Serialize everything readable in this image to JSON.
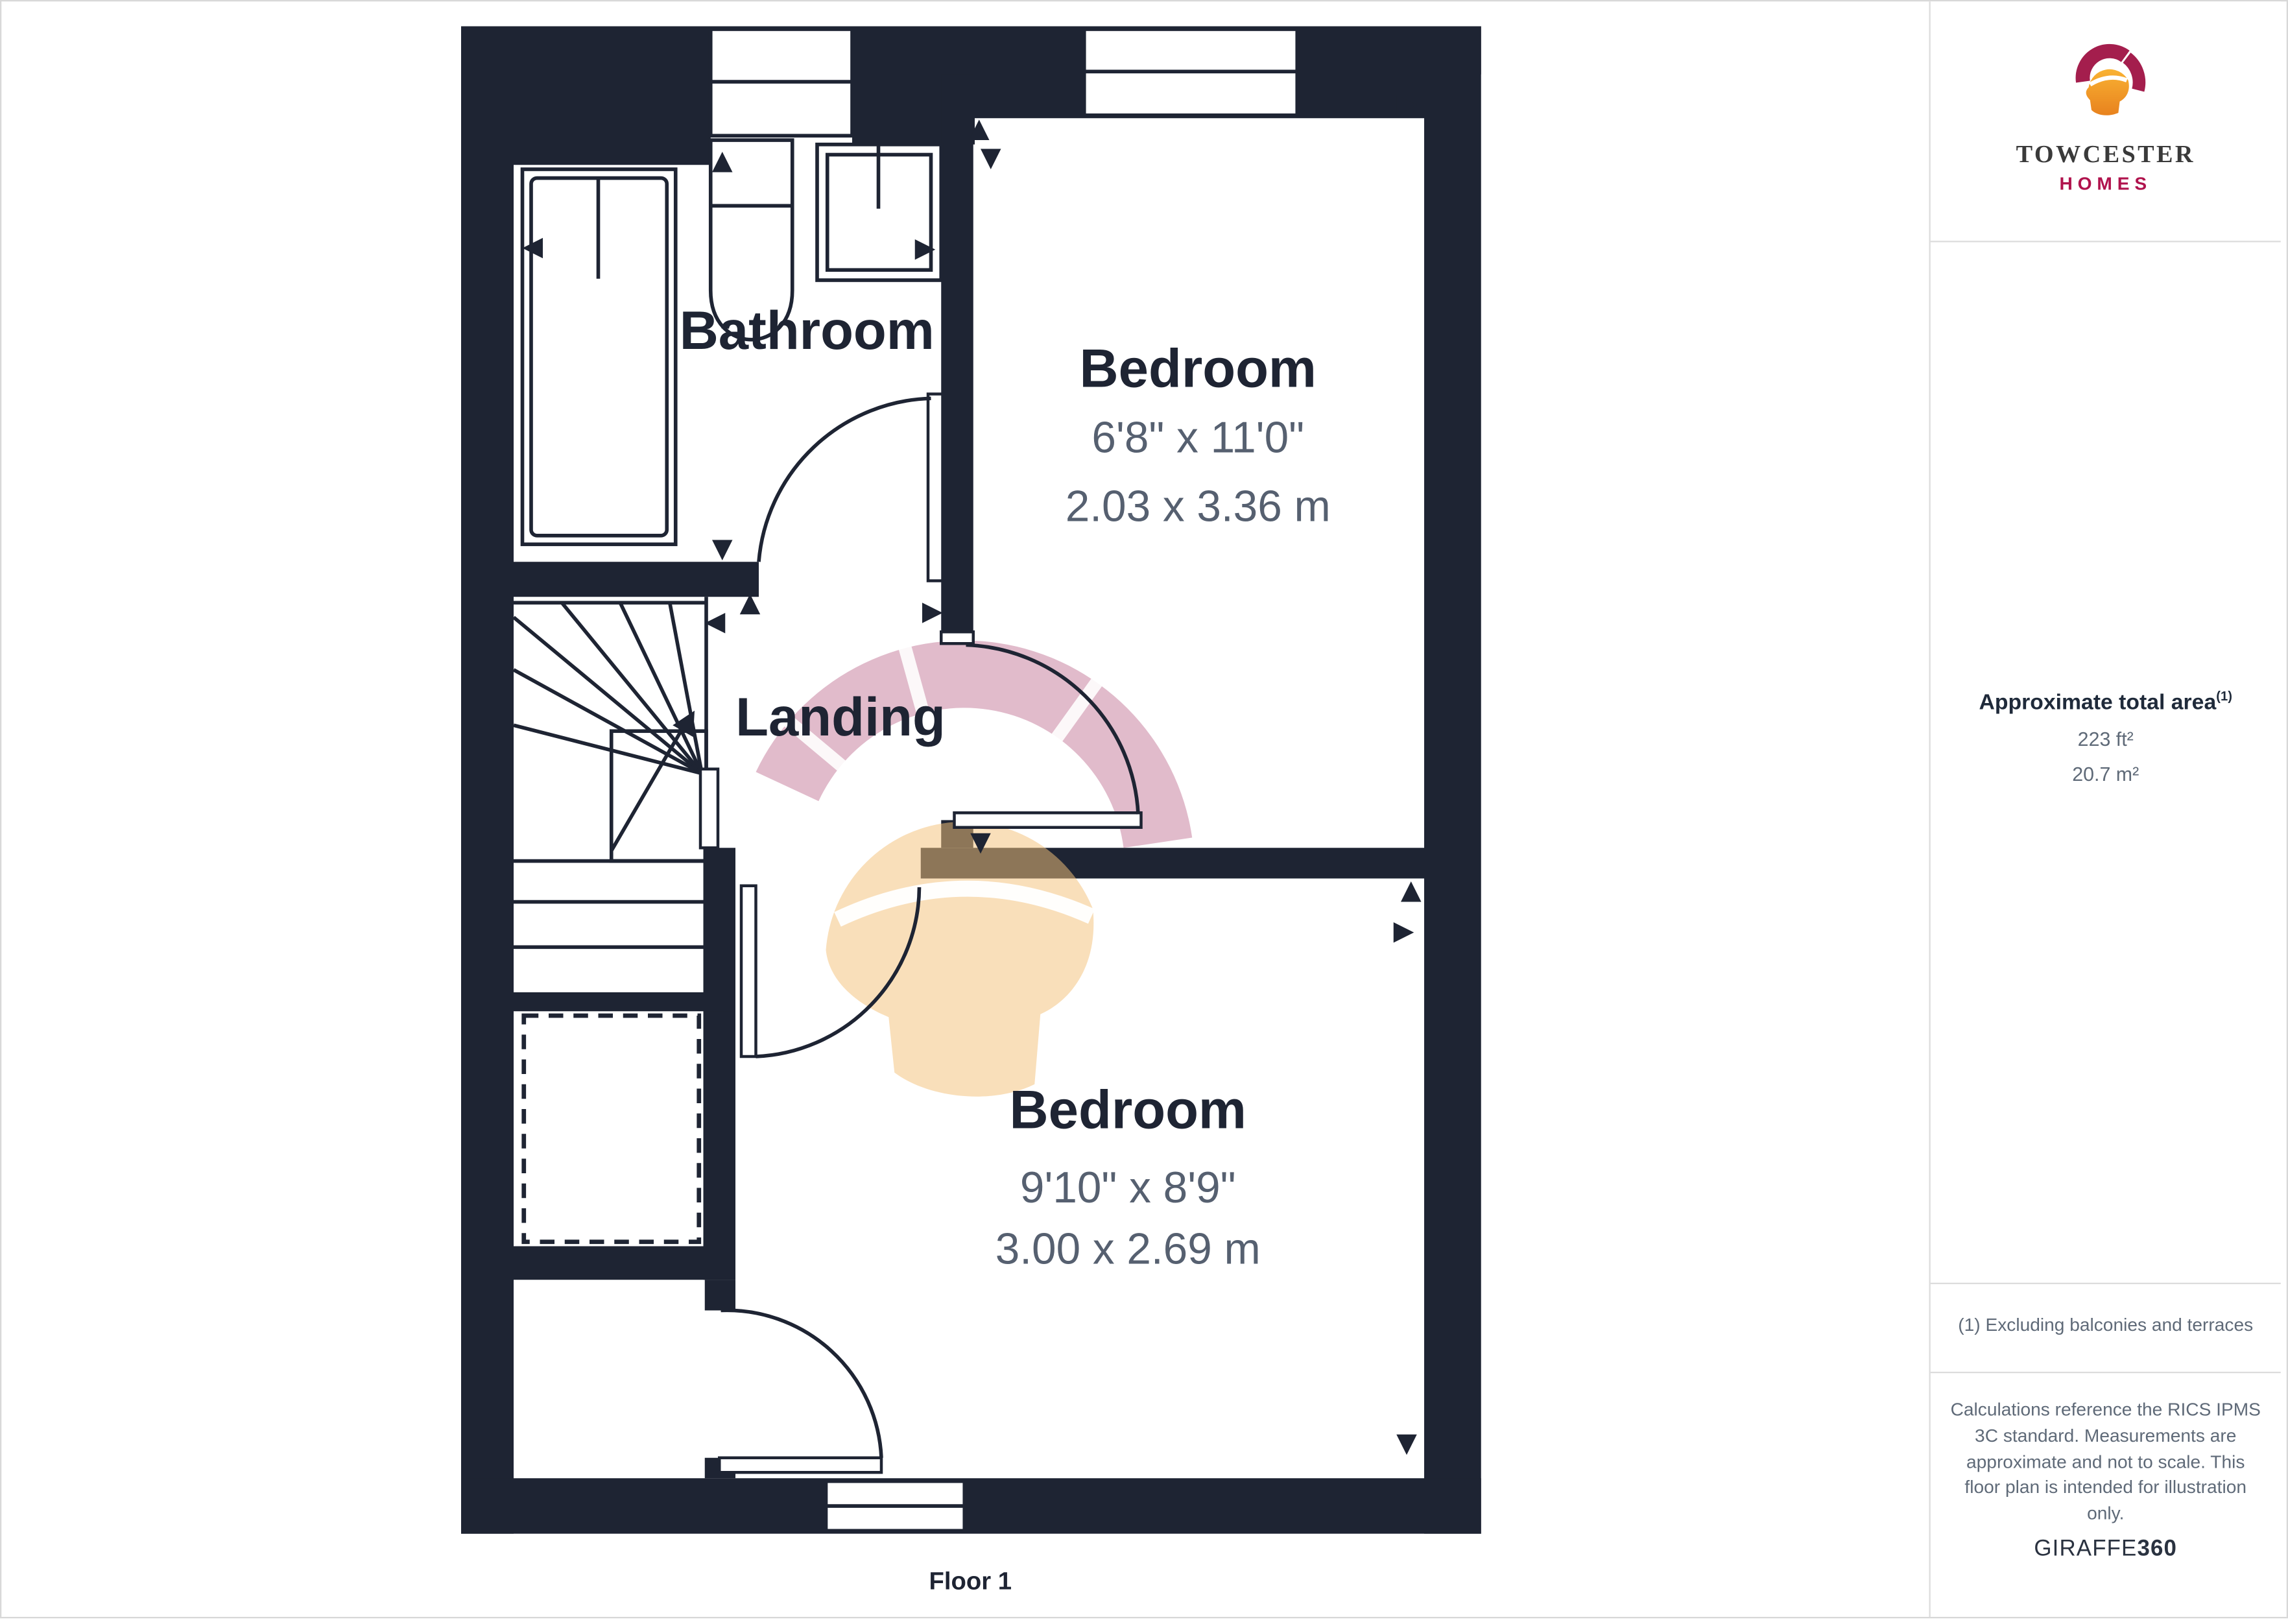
{
  "plan": {
    "floor_label": "Floor 1",
    "rooms": {
      "bathroom": {
        "name": "Bathroom"
      },
      "bedroom1": {
        "name": "Bedroom",
        "imperial": "6'8\" x 11'0\"",
        "metric": "2.03 x 3.36 m"
      },
      "landing": {
        "name": "Landing"
      },
      "bedroom2": {
        "name": "Bedroom",
        "imperial": "9'10\" x 8'9\"",
        "metric": "3.00 x 2.69 m"
      }
    }
  },
  "sidebar": {
    "logo": {
      "name": "TOWCESTER",
      "subname": "HOMES"
    },
    "area": {
      "title": "Approximate total area",
      "footnote_marker": "(1)",
      "imperial": "223 ft²",
      "metric": "20.7 m²"
    },
    "footnote": "(1) Excluding balconies and terraces",
    "disclaimer": "Calculations reference the RICS IPMS 3C standard. Measurements are approximate and not to scale. This floor plan is intended for illustration only.",
    "brand": {
      "part1": "GIRAFFE",
      "part2": "360"
    }
  },
  "colors": {
    "wall": "#1e2433",
    "dim_text": "#566070",
    "accent": "#b0134d",
    "border": "#dcdcdc"
  }
}
